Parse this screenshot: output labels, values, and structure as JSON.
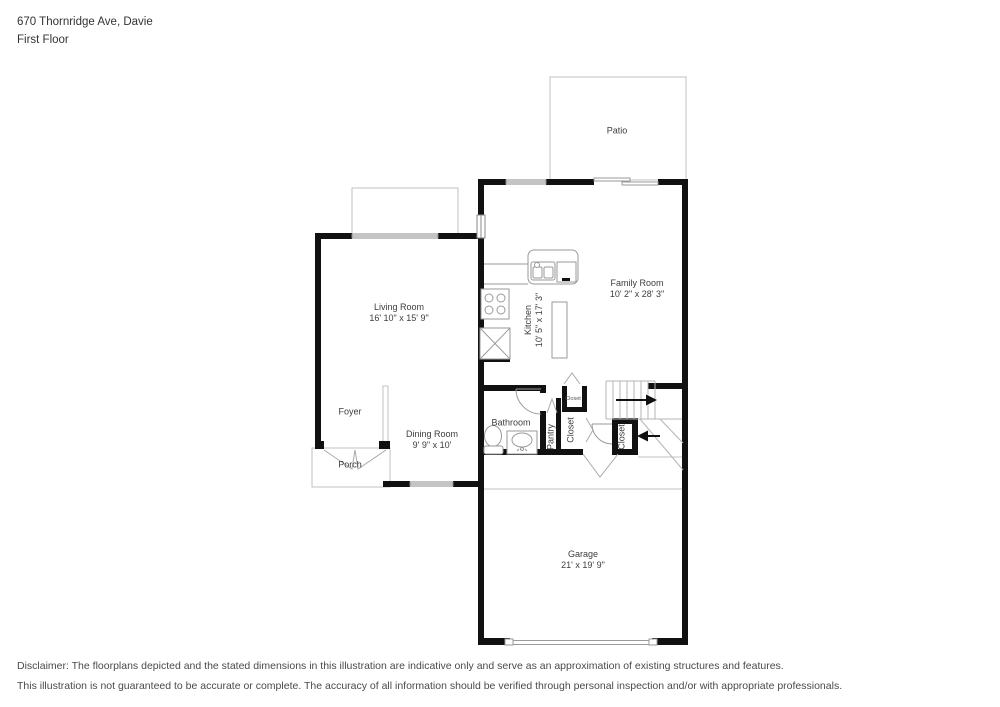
{
  "header": {
    "address": "670 Thornridge Ave, Davie",
    "floor": "First Floor"
  },
  "rooms": {
    "patio": {
      "name": "Patio"
    },
    "family_room": {
      "name": "Family Room",
      "dims": "10' 2\" x 28' 3\""
    },
    "living_room": {
      "name": "Living Room",
      "dims": "16' 10\" x 15' 9\""
    },
    "kitchen": {
      "name": "Kitchen",
      "dims": "10' 5\" x 17' 3\""
    },
    "dining_room": {
      "name": "Dining Room",
      "dims": "9' 9\" x 10'"
    },
    "foyer": {
      "name": "Foyer"
    },
    "porch": {
      "name": "Porch"
    },
    "bathroom": {
      "name": "Bathroom"
    },
    "pantry": {
      "name": "Pantry"
    },
    "closet_hall_small": {
      "name": "Closet"
    },
    "closet_hall": {
      "name": "Closet"
    },
    "closet_stairs": {
      "name": "Closet"
    },
    "garage": {
      "name": "Garage",
      "dims": "21' x 19' 9\""
    }
  },
  "disclaimer": {
    "line1": "Disclaimer: The floorplans depicted and the stated dimensions in this illustration are indicative only and serve as an approximation of existing structures and features.",
    "line2": "This illustration is not guaranteed to be accurate or complete. The accuracy of all information should be verified through personal inspection and/or with appropriate professionals."
  },
  "colors": {
    "wall": "#111111",
    "thin_line": "#c2c2c2",
    "fixture_line": "#9a9a9a",
    "text": "#3d3d3d"
  }
}
